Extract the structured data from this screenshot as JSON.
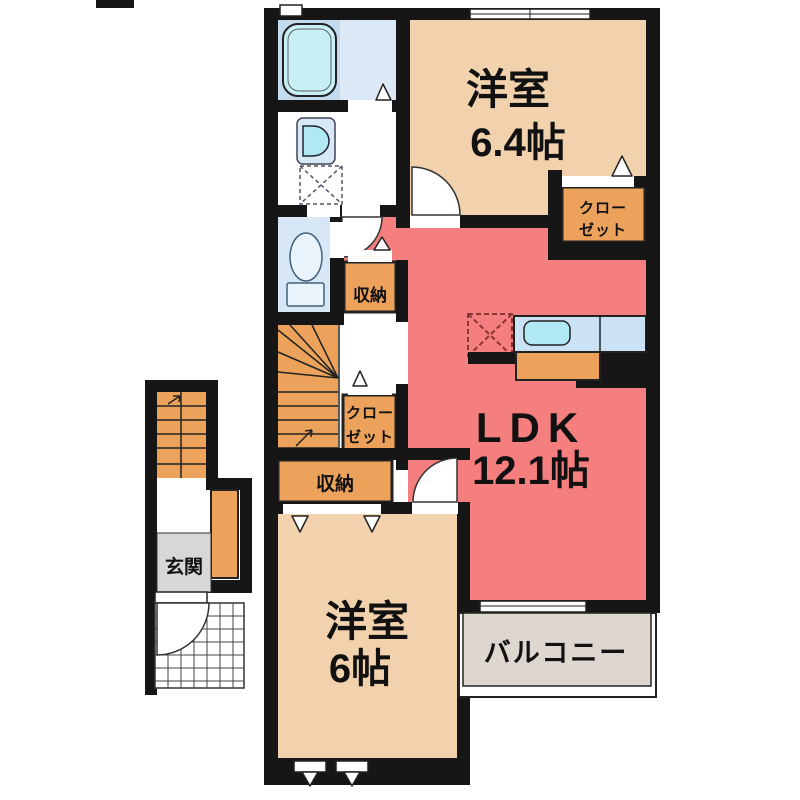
{
  "plan": {
    "room1": {
      "name": "洋室",
      "size": "6.4帖"
    },
    "ldk": {
      "name": "LDK",
      "size": "12.1帖"
    },
    "room2": {
      "name": "洋室",
      "size": "6帖"
    },
    "balcony_label": "バルコニー",
    "entrance_label": "玄関",
    "storage_upper_label": "収納",
    "storage_lower_label": "収納",
    "closet_upper": {
      "line1": "クロー",
      "line2": "ゼット"
    },
    "closet_middle": {
      "line1": "クロー",
      "line2": "ゼット"
    }
  },
  "colors": {
    "wall": "#161616",
    "ldk_salmon": "#f57e7e",
    "room_beige": "#f2d2ad",
    "storage_orange": "#eca25a",
    "stairs_orange": "#eca25a",
    "bathroom_panel": "#c4dbee",
    "bathroom_light": "#dce9f6",
    "tub_cyan": "#c8eef6",
    "toilet_room_blue": "#d8e7f5",
    "fixture_cyan": "#b0e8f3",
    "basin_fill": "#d7e9f7",
    "counter_blue": "#cbe2f4",
    "entrance_gray": "#d7d7d7",
    "balcony_gray": "#ddd7cf"
  }
}
